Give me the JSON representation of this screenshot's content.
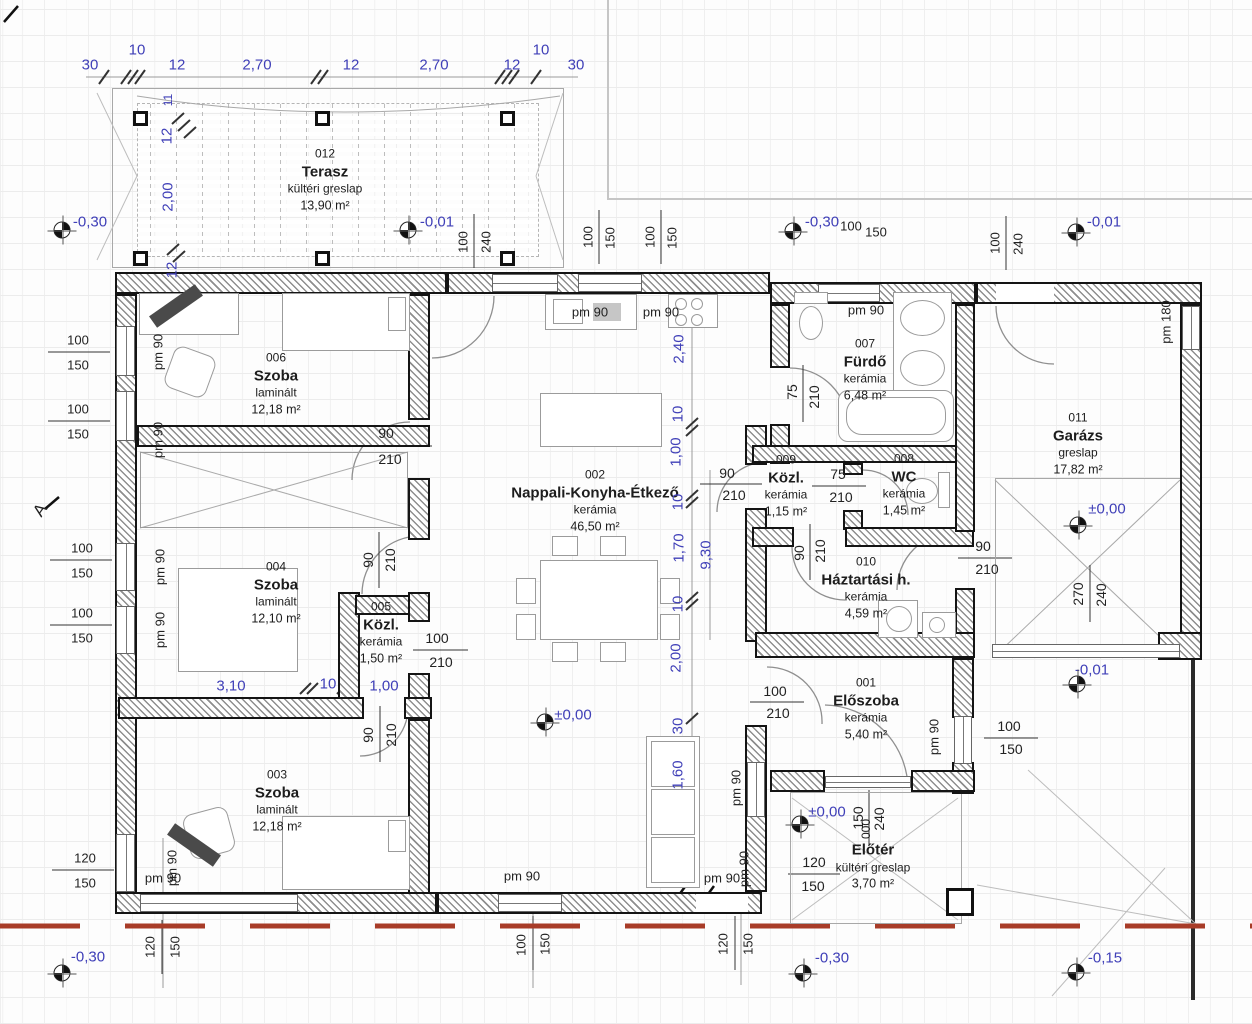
{
  "rooms": [
    {
      "number": "012",
      "name": "Terasz",
      "material": "kültéri greslap",
      "area": "13,90 m²"
    },
    {
      "number": "006",
      "name": "Szoba",
      "material": "laminált",
      "area": "12,18 m²"
    },
    {
      "number": "004",
      "name": "Szoba",
      "material": "laminált",
      "area": "12,10 m²"
    },
    {
      "number": "005",
      "name": "Közl.",
      "material": "kerámia",
      "area": "1,50 m²"
    },
    {
      "number": "003",
      "name": "Szoba",
      "material": "laminált",
      "area": "12,18 m²"
    },
    {
      "number": "002",
      "name": "Nappali-Konyha-Étkező",
      "material": "kerámia",
      "area": "46,50 m²"
    },
    {
      "number": "007",
      "name": "Fürdő",
      "material": "kerámia",
      "area": "6,48 m²"
    },
    {
      "number": "009",
      "name": "Közl.",
      "material": "kerámia",
      "area": "1,15 m²"
    },
    {
      "number": "008",
      "name": "WC",
      "material": "kerámia",
      "area": "1,45 m²"
    },
    {
      "number": "010",
      "name": "Háztartási h.",
      "material": "kerámia",
      "area": "4,59 m²"
    },
    {
      "number": "001",
      "name": "Előszoba",
      "material": "kerámia",
      "area": "5,40 m²"
    },
    {
      "number": "000",
      "name": "Előtér",
      "material": "kültéri greslap",
      "area": "3,70 m²"
    },
    {
      "number": "011",
      "name": "Garázs",
      "material": "greslap",
      "area": "17,82 m²"
    }
  ],
  "colors": {
    "dimension_blue": "#4040b8",
    "text_black": "#222222",
    "boundary_red": "#a83c28"
  },
  "annotations": [
    {
      "t": "30",
      "x": 90,
      "y": 65,
      "c": "b",
      "s": 15,
      "k": "chain"
    },
    {
      "t": "10",
      "x": 137,
      "y": 50,
      "c": "b",
      "s": 15,
      "k": "chain"
    },
    {
      "t": "12",
      "x": 177,
      "y": 65,
      "c": "b",
      "s": 15,
      "k": "chain"
    },
    {
      "t": "2,70",
      "x": 257,
      "y": 65,
      "c": "b",
      "s": 15,
      "k": "chain"
    },
    {
      "t": "12",
      "x": 351,
      "y": 65,
      "c": "b",
      "s": 15,
      "k": "chain"
    },
    {
      "t": "2,70",
      "x": 434,
      "y": 65,
      "c": "b",
      "s": 15,
      "k": "chain"
    },
    {
      "t": "12",
      "x": 512,
      "y": 65,
      "c": "b",
      "s": 15,
      "k": "chain"
    },
    {
      "t": "10",
      "x": 541,
      "y": 50,
      "c": "b",
      "s": 15,
      "k": "chain"
    },
    {
      "t": "30",
      "x": 576,
      "y": 65,
      "c": "b",
      "s": 15,
      "k": "chain"
    },
    {
      "t": "11",
      "x": 168,
      "y": 100,
      "r": -90,
      "c": "b",
      "s": 12,
      "k": "chain"
    },
    {
      "t": "12",
      "x": 167,
      "y": 136,
      "r": -90,
      "c": "b",
      "s": 15,
      "k": "chain"
    },
    {
      "t": "2,00",
      "x": 168,
      "y": 197,
      "r": -90,
      "c": "b",
      "s": 15,
      "k": "chain"
    },
    {
      "t": "12",
      "x": 172,
      "y": 270,
      "r": -90,
      "c": "b",
      "s": 15,
      "k": "chain"
    },
    {
      "t": "100",
      "x": 463,
      "y": 242,
      "r": -90,
      "s": 13
    },
    {
      "t": "240",
      "x": 486,
      "y": 242,
      "r": -90,
      "s": 13
    },
    {
      "t": "100",
      "x": 588,
      "y": 237,
      "r": -90,
      "s": 13
    },
    {
      "t": "150",
      "x": 610,
      "y": 238,
      "r": -90,
      "s": 13
    },
    {
      "t": "100",
      "x": 650,
      "y": 237,
      "r": -90,
      "s": 13
    },
    {
      "t": "150",
      "x": 672,
      "y": 238,
      "r": -90,
      "s": 13
    },
    {
      "t": "100",
      "x": 851,
      "y": 226,
      "s": 13
    },
    {
      "t": "150",
      "x": 876,
      "y": 232,
      "s": 13
    },
    {
      "t": "100",
      "x": 995,
      "y": 243,
      "r": -90,
      "s": 13
    },
    {
      "t": "240",
      "x": 1018,
      "y": 244,
      "r": -90,
      "s": 13
    },
    {
      "t": "-0,30",
      "x": 90,
      "y": 222,
      "c": "b",
      "s": 15,
      "k": "elev"
    },
    {
      "t": "-0,01",
      "x": 437,
      "y": 222,
      "c": "b",
      "s": 15,
      "k": "elev"
    },
    {
      "t": "-0,30",
      "x": 822,
      "y": 222,
      "c": "b",
      "s": 15,
      "k": "elev"
    },
    {
      "t": "-0,01",
      "x": 1104,
      "y": 222,
      "c": "b",
      "s": 15,
      "k": "elev"
    },
    {
      "t": "±0,00",
      "x": 573,
      "y": 715,
      "c": "b",
      "s": 15,
      "k": "elev"
    },
    {
      "t": "±0,00",
      "x": 1107,
      "y": 509,
      "c": "b",
      "s": 15,
      "k": "elev"
    },
    {
      "t": "-0,01",
      "x": 1092,
      "y": 670,
      "c": "b",
      "s": 15,
      "k": "elev"
    },
    {
      "t": "±0,00",
      "x": 827,
      "y": 812,
      "c": "b",
      "s": 15,
      "k": "elev"
    },
    {
      "t": "-0,30",
      "x": 88,
      "y": 957,
      "c": "b",
      "s": 15,
      "k": "elev"
    },
    {
      "t": "-0,30",
      "x": 832,
      "y": 958,
      "c": "b",
      "s": 15,
      "k": "elev"
    },
    {
      "t": "-0,15",
      "x": 1105,
      "y": 958,
      "c": "b",
      "s": 15,
      "k": "elev"
    },
    {
      "x": 62,
      "y": 230,
      "k": "sym"
    },
    {
      "x": 408,
      "y": 230,
      "k": "sym"
    },
    {
      "x": 793,
      "y": 231,
      "k": "sym"
    },
    {
      "x": 1076,
      "y": 232,
      "k": "sym"
    },
    {
      "x": 545,
      "y": 722,
      "k": "sym"
    },
    {
      "x": 1078,
      "y": 525,
      "k": "sym"
    },
    {
      "x": 1077,
      "y": 684,
      "k": "sym"
    },
    {
      "x": 800,
      "y": 824,
      "k": "sym"
    },
    {
      "x": 62,
      "y": 973,
      "k": "sym"
    },
    {
      "x": 803,
      "y": 973,
      "k": "sym"
    },
    {
      "x": 1076,
      "y": 972,
      "k": "sym"
    },
    {
      "t": "100",
      "x": 78,
      "y": 340,
      "s": 13
    },
    {
      "t": "150",
      "x": 78,
      "y": 365,
      "s": 13
    },
    {
      "t": "100",
      "x": 78,
      "y": 409,
      "s": 13
    },
    {
      "t": "150",
      "x": 78,
      "y": 434,
      "s": 13
    },
    {
      "t": "100",
      "x": 82,
      "y": 548,
      "s": 13
    },
    {
      "t": "150",
      "x": 82,
      "y": 573,
      "s": 13
    },
    {
      "t": "100",
      "x": 82,
      "y": 613,
      "s": 13
    },
    {
      "t": "150",
      "x": 82,
      "y": 638,
      "s": 13
    },
    {
      "t": "120",
      "x": 85,
      "y": 858,
      "s": 13
    },
    {
      "t": "150",
      "x": 85,
      "y": 883,
      "s": 13
    },
    {
      "t": "A",
      "x": 40,
      "y": 510,
      "r": -55,
      "s": 17,
      "k": "axis"
    },
    {
      "t": "pm 90",
      "x": 158,
      "y": 352,
      "r": -90,
      "s": 13,
      "k": "pm"
    },
    {
      "t": "pm 90",
      "x": 158,
      "y": 440,
      "r": -90,
      "s": 13,
      "k": "pm"
    },
    {
      "t": "pm 90",
      "x": 160,
      "y": 567,
      "r": -90,
      "s": 13,
      "k": "pm"
    },
    {
      "t": "pm 90",
      "x": 160,
      "y": 630,
      "r": -90,
      "s": 13,
      "k": "pm"
    },
    {
      "t": "pm 90",
      "x": 172,
      "y": 868,
      "r": -90,
      "s": 13,
      "k": "pm"
    },
    {
      "t": "pm 180",
      "x": 1166,
      "y": 322,
      "r": -90,
      "s": 13,
      "k": "pm"
    },
    {
      "t": "pm 90",
      "x": 934,
      "y": 737,
      "r": -90,
      "s": 13,
      "k": "pm"
    },
    {
      "t": "pm 90",
      "x": 736,
      "y": 788,
      "r": -90,
      "s": 13,
      "k": "pm"
    },
    {
      "t": "pm 90",
      "x": 744,
      "y": 869,
      "r": -90,
      "s": 13,
      "k": "pm"
    },
    {
      "t": "pm 90",
      "x": 590,
      "y": 312,
      "s": 13,
      "k": "pm"
    },
    {
      "t": "pm 90",
      "x": 661,
      "y": 312,
      "s": 13,
      "k": "pm"
    },
    {
      "t": "pm 90",
      "x": 866,
      "y": 310,
      "s": 13,
      "k": "pm"
    },
    {
      "t": "pm 90",
      "x": 163,
      "y": 878,
      "s": 13,
      "k": "pm"
    },
    {
      "t": "pm 90",
      "x": 522,
      "y": 876,
      "s": 13,
      "k": "pm"
    },
    {
      "t": "pm 90",
      "x": 722,
      "y": 878,
      "s": 13,
      "k": "pm"
    },
    {
      "t": "2,40",
      "x": 679,
      "y": 349,
      "r": -90,
      "c": "b",
      "s": 15,
      "k": "chain"
    },
    {
      "t": "10",
      "x": 678,
      "y": 414,
      "r": -90,
      "c": "b",
      "s": 15,
      "k": "chain"
    },
    {
      "t": "1,00",
      "x": 676,
      "y": 452,
      "r": -90,
      "c": "b",
      "s": 15,
      "k": "chain"
    },
    {
      "t": "10",
      "x": 678,
      "y": 502,
      "r": -90,
      "c": "b",
      "s": 15,
      "k": "chain"
    },
    {
      "t": "1,70",
      "x": 679,
      "y": 548,
      "r": -90,
      "c": "b",
      "s": 15,
      "k": "chain"
    },
    {
      "t": "9,30",
      "x": 706,
      "y": 555,
      "r": -90,
      "c": "b",
      "s": 15,
      "k": "chain"
    },
    {
      "t": "10",
      "x": 678,
      "y": 604,
      "r": -90,
      "c": "b",
      "s": 15,
      "k": "chain"
    },
    {
      "t": "2,00",
      "x": 676,
      "y": 658,
      "r": -90,
      "c": "b",
      "s": 15,
      "k": "chain"
    },
    {
      "t": "30",
      "x": 678,
      "y": 726,
      "r": -90,
      "c": "b",
      "s": 15,
      "k": "chain"
    },
    {
      "t": "1,60",
      "x": 678,
      "y": 775,
      "r": -90,
      "c": "b",
      "s": 15,
      "k": "chain"
    },
    {
      "t": "3,10",
      "x": 231,
      "y": 686,
      "c": "b",
      "s": 15,
      "k": "chain"
    },
    {
      "t": "10",
      "x": 328,
      "y": 684,
      "c": "b",
      "s": 15,
      "k": "chain"
    },
    {
      "t": "1,00",
      "x": 384,
      "y": 686,
      "c": "b",
      "s": 15,
      "k": "chain"
    },
    {
      "t": "90",
      "x": 386,
      "y": 433
    },
    {
      "t": "210",
      "x": 390,
      "y": 459
    },
    {
      "t": "90",
      "x": 727,
      "y": 473
    },
    {
      "t": "210",
      "x": 734,
      "y": 495
    },
    {
      "t": "100",
      "x": 437,
      "y": 638
    },
    {
      "t": "210",
      "x": 441,
      "y": 662
    },
    {
      "t": "75",
      "x": 838,
      "y": 474
    },
    {
      "t": "210",
      "x": 841,
      "y": 497
    },
    {
      "t": "90",
      "x": 983,
      "y": 546
    },
    {
      "t": "210",
      "x": 987,
      "y": 569
    },
    {
      "t": "100",
      "x": 775,
      "y": 691
    },
    {
      "t": "210",
      "x": 778,
      "y": 713
    },
    {
      "t": "100",
      "x": 1009,
      "y": 726
    },
    {
      "t": "150",
      "x": 1011,
      "y": 749
    },
    {
      "t": "120",
      "x": 814,
      "y": 862
    },
    {
      "t": "150",
      "x": 813,
      "y": 886
    },
    {
      "t": "90",
      "x": 368,
      "y": 560,
      "r": -90
    },
    {
      "t": "210",
      "x": 390,
      "y": 560,
      "r": -90
    },
    {
      "t": "90",
      "x": 368,
      "y": 735,
      "r": -90
    },
    {
      "t": "210",
      "x": 391,
      "y": 735,
      "r": -90
    },
    {
      "t": "75",
      "x": 792,
      "y": 392,
      "r": -90
    },
    {
      "t": "210",
      "x": 814,
      "y": 397,
      "r": -90
    },
    {
      "t": "90",
      "x": 799,
      "y": 553,
      "r": -90
    },
    {
      "t": "210",
      "x": 820,
      "y": 551,
      "r": -90
    },
    {
      "t": "270",
      "x": 1078,
      "y": 594,
      "r": -90
    },
    {
      "t": "240",
      "x": 1101,
      "y": 595,
      "r": -90
    },
    {
      "t": "150",
      "x": 858,
      "y": 818,
      "r": -90
    },
    {
      "t": "240",
      "x": 879,
      "y": 819,
      "r": -90
    },
    {
      "t": "120",
      "x": 150,
      "y": 947,
      "r": -90,
      "s": 13
    },
    {
      "t": "150",
      "x": 175,
      "y": 947,
      "r": -90,
      "s": 13
    },
    {
      "t": "100",
      "x": 521,
      "y": 945,
      "r": -90,
      "s": 13
    },
    {
      "t": "150",
      "x": 545,
      "y": 944,
      "r": -90,
      "s": 13
    },
    {
      "t": "120",
      "x": 723,
      "y": 944,
      "r": -90,
      "s": 13
    },
    {
      "t": "150",
      "x": 748,
      "y": 944,
      "r": -90,
      "s": 13
    }
  ]
}
